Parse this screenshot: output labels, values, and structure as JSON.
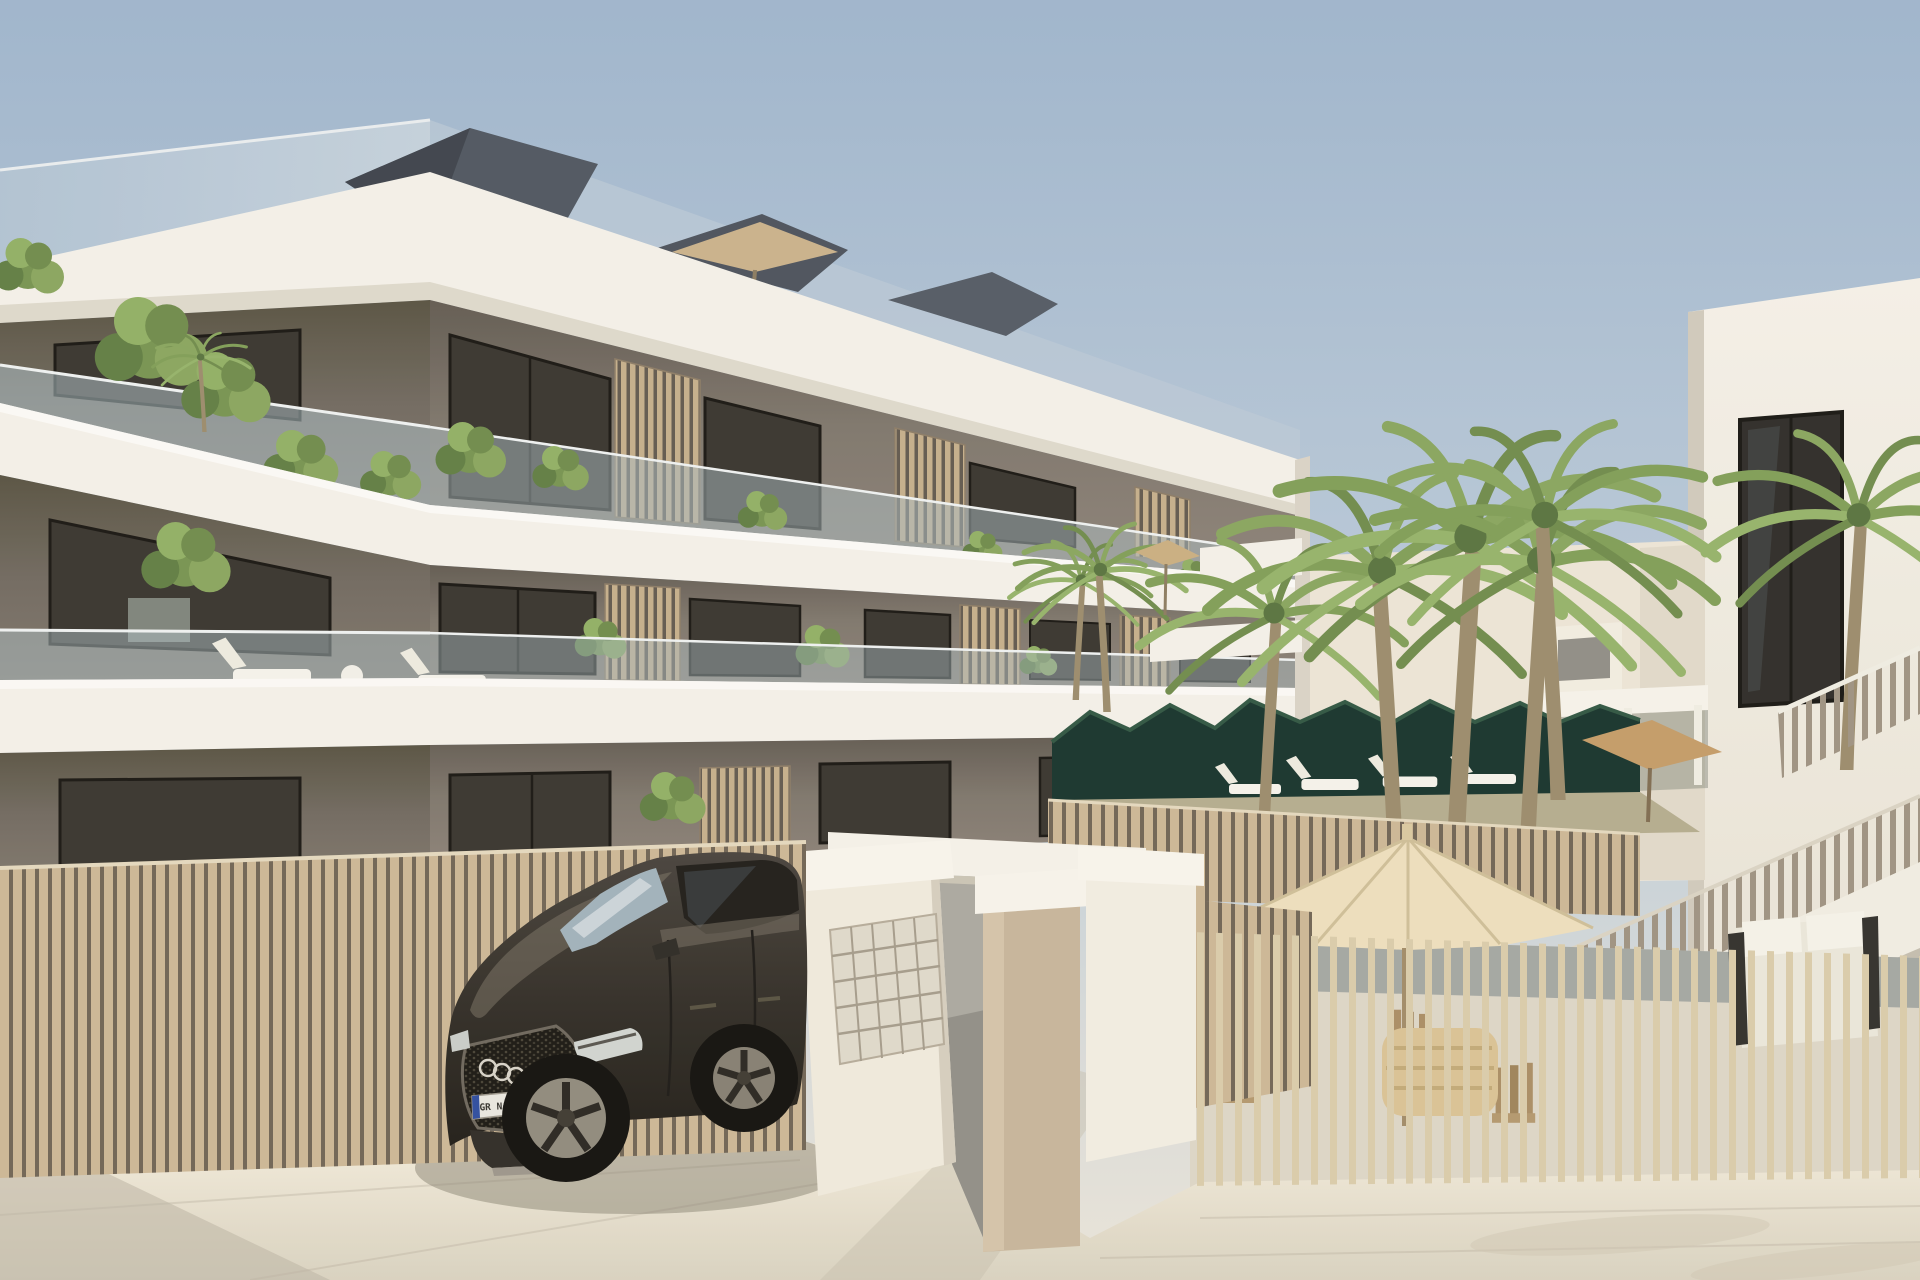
{
  "meta": {
    "title": "New-build apartment complex - exterior 3D render",
    "type": "architectural-visualization",
    "description": "Sunny 3D render of a modern three-storey apartment building with white balcony bands, taupe recessed walls, glass balustrades and wooden slat screens; a dark SUV is parked by the entrance gate with a mailbox wall; a palm-filled courtyard with cream parasols, loungers, a hedge and a white side building with an external staircase sits to the right, all behind beige vertical-slat fencing."
  },
  "scene": {
    "sky": {
      "top": "#9db4cc",
      "mid": "#bccbd9",
      "horizon": "#e9e4d8"
    },
    "palette": {
      "band_white": "#f3f0e8",
      "wall_taupe": "#7c746a",
      "wall_taupe_dark": "#5f584f",
      "roof_slate": "#4c545e",
      "window_glass_dark": "#2e2b25",
      "balustrade_glass": "#a9bbc2",
      "slat_wood": "#c3ad8a",
      "fence_wood": "#cbb694",
      "fence_gap": "#6e6253",
      "hedge_green": "#14312a",
      "palm_green": "#7e9c55",
      "umbrella_cream": "#ecdebc",
      "umbrella_tan": "#c29a66",
      "car_body": "#2f2b24",
      "pavement": "#ece6d7",
      "pavement_shadow": "#b9b2a2"
    },
    "objects": [
      {
        "name": "main-apartment-building",
        "desc": "three storeys, white slab bands, glass balconies, wood slat screens, balcony plants"
      },
      {
        "name": "roof-terrace",
        "desc": "glass railing, dark angular roof elements, tan parasol"
      },
      {
        "name": "entrance-gate",
        "desc": "white walls and lintel, mailbox panel with 25 slots, beige pillar"
      },
      {
        "name": "left-slat-fence",
        "desc": "beige vertical wooden slats along the street"
      },
      {
        "name": "parked-suv",
        "desc": "dark Audi-style SUV with mesh grille, four-ring emblem, front plate"
      },
      {
        "name": "patio",
        "desc": "large cream parasol, wooden chairs, rattan table behind open slat fence"
      },
      {
        "name": "courtyard",
        "desc": "palm trees, dark hedge, white sun loungers, pergola, small parasols"
      },
      {
        "name": "side-building",
        "desc": "white building with dark windows and external staircase with slat railing"
      },
      {
        "name": "street-pavement",
        "desc": "light stone paving with soft shadows"
      }
    ]
  },
  "car": {
    "emblem": "four-rings",
    "license_plate": "GR NA 0740",
    "plate_band_color": "#2b4a9e",
    "body_color": "#2f2b24"
  }
}
